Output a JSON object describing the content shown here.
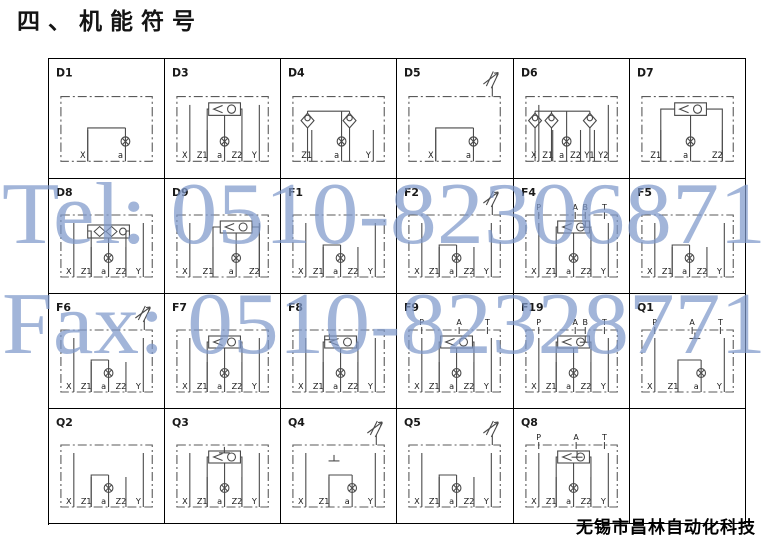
{
  "page": {
    "title": "四、机能符号",
    "footer": "无锡市昌林自动化科技"
  },
  "watermark": {
    "line1": "Tel: 0510-82306871",
    "line2": "Fax: 0510-82328771",
    "color": "#7E99CB"
  },
  "colors": {
    "line": "#4a4a4a",
    "envelope": "#5a5a5a",
    "label": "#1a1a1a",
    "border": "#000000"
  },
  "cells": [
    {
      "id": "D1",
      "ports": [
        "X",
        "a"
      ],
      "top": [],
      "kind": "bridge",
      "checks": [],
      "relief": false,
      "tank": null
    },
    {
      "id": "D3",
      "ports": [
        "X",
        "Z1",
        "a",
        "Z2",
        "Y"
      ],
      "top": [],
      "kind": "shuttle",
      "checks": [],
      "relief": false,
      "tank": null
    },
    {
      "id": "D4",
      "ports": [
        "Z1",
        "a",
        "Y"
      ],
      "top": [],
      "kind": "checks",
      "checks": [
        0.16,
        0.62
      ],
      "relief": false,
      "tank": null
    },
    {
      "id": "D5",
      "ports": [
        "X",
        "a"
      ],
      "top": [],
      "kind": "bridge",
      "checks": [],
      "relief": true,
      "tank": null
    },
    {
      "id": "D6",
      "ports": [
        "X",
        "Z1",
        "a",
        "Z2",
        "Y1",
        "Y2"
      ],
      "top": [],
      "kind": "checks",
      "checks": [
        0.1,
        0.28,
        0.7
      ],
      "relief": false,
      "tank": null
    },
    {
      "id": "D7",
      "ports": [
        "Z1",
        "a",
        "Z2"
      ],
      "top": [],
      "kind": "shuttle",
      "checks": [],
      "relief": false,
      "tank": null
    },
    {
      "id": "D8",
      "ports": [
        "X",
        "Z1",
        "a",
        "Z2",
        "Y"
      ],
      "top": [],
      "kind": "dblcheck",
      "checks": [],
      "relief": false,
      "tank": null
    },
    {
      "id": "D9",
      "ports": [
        "X",
        "Z1",
        "a",
        "Z2"
      ],
      "top": [],
      "kind": "shuttle",
      "checks": [],
      "relief": false,
      "tank": null
    },
    {
      "id": "F1",
      "ports": [
        "X",
        "Z1",
        "a",
        "Z2",
        "Y"
      ],
      "top": [],
      "kind": "bridge",
      "checks": [],
      "relief": false,
      "tank": null
    },
    {
      "id": "F2",
      "ports": [
        "X",
        "Z1",
        "a",
        "Z2",
        "Y"
      ],
      "top": [],
      "kind": "bridge",
      "checks": [],
      "relief": true,
      "tank": null
    },
    {
      "id": "F4",
      "ports": [
        "X",
        "Z1",
        "a",
        "Z2",
        "Y"
      ],
      "top": [
        {
          "t": "P",
          "f": 0.14
        },
        {
          "t": "A",
          "f": 0.54
        },
        {
          "t": "B",
          "f": 0.65
        },
        {
          "t": "T",
          "f": 0.86
        }
      ],
      "kind": "shuttle",
      "checks": [],
      "relief": false,
      "tank": [
        0.65,
        0.1
      ]
    },
    {
      "id": "F5",
      "ports": [
        "X",
        "Z1",
        "a",
        "Z2",
        "Y"
      ],
      "top": [],
      "kind": "bridge",
      "checks": [],
      "relief": false,
      "tank": null
    },
    {
      "id": "F6",
      "ports": [
        "X",
        "Z1",
        "a",
        "Z2",
        "Y"
      ],
      "top": [],
      "kind": "bridge",
      "checks": [],
      "relief": true,
      "tank": null
    },
    {
      "id": "F7",
      "ports": [
        "X",
        "Z1",
        "a",
        "Z2",
        "Y"
      ],
      "top": [],
      "kind": "shuttle",
      "checks": [],
      "relief": false,
      "tank": null
    },
    {
      "id": "F8",
      "ports": [
        "X",
        "Z1",
        "a",
        "Z2",
        "Y"
      ],
      "top": [],
      "kind": "shuttle",
      "checks": [],
      "relief": false,
      "tank": [
        0.4,
        0.06
      ]
    },
    {
      "id": "F9",
      "ports": [
        "X",
        "Z1",
        "a",
        "Z2",
        "Y"
      ],
      "top": [
        {
          "t": "P",
          "f": 0.14
        },
        {
          "t": "A",
          "f": 0.55
        },
        {
          "t": "T",
          "f": 0.86
        }
      ],
      "kind": "shuttle",
      "checks": [],
      "relief": false,
      "tank": null
    },
    {
      "id": "F19",
      "ports": [
        "X",
        "Z1",
        "a",
        "Z2",
        "Y"
      ],
      "top": [
        {
          "t": "P",
          "f": 0.14
        },
        {
          "t": "A",
          "f": 0.54
        },
        {
          "t": "B",
          "f": 0.65
        },
        {
          "t": "T",
          "f": 0.86
        }
      ],
      "kind": "shuttle",
      "checks": [],
      "relief": false,
      "tank": [
        0.65,
        0.1
      ]
    },
    {
      "id": "Q1",
      "ports": [
        "X",
        "Z1",
        "a",
        "Y"
      ],
      "top": [
        {
          "t": "P",
          "f": 0.14
        },
        {
          "t": "A",
          "f": 0.55
        },
        {
          "t": "T",
          "f": 0.86
        }
      ],
      "kind": "bridge",
      "checks": [],
      "relief": false,
      "tank": [
        0.58,
        0.04
      ]
    },
    {
      "id": "Q2",
      "ports": [
        "X",
        "Z1",
        "a",
        "Z2",
        "Y"
      ],
      "top": [],
      "kind": "bridge",
      "checks": [],
      "relief": false,
      "tank": null
    },
    {
      "id": "Q3",
      "ports": [
        "X",
        "Z1",
        "a",
        "Z2",
        "Y"
      ],
      "top": [],
      "kind": "shuttle",
      "checks": [],
      "relief": false,
      "tank": [
        0.52,
        0.03
      ]
    },
    {
      "id": "Q4",
      "ports": [
        "X",
        "Z1",
        "a",
        "Y"
      ],
      "top": [],
      "kind": "bridge",
      "checks": [],
      "relief": true,
      "tank": [
        0.45,
        0.16
      ]
    },
    {
      "id": "Q5",
      "ports": [
        "X",
        "Z1",
        "a",
        "Z2",
        "Y"
      ],
      "top": [],
      "kind": "bridge",
      "checks": [],
      "relief": true,
      "tank": null
    },
    {
      "id": "Q8",
      "ports": [
        "X",
        "Z1",
        "a",
        "Z2",
        "Y"
      ],
      "top": [
        {
          "t": "P",
          "f": 0.14
        },
        {
          "t": "A",
          "f": 0.55
        },
        {
          "t": "T",
          "f": 0.86
        }
      ],
      "kind": "shuttle",
      "checks": [],
      "relief": false,
      "tank": [
        0.56,
        0.1
      ]
    },
    {
      "id": "",
      "ports": [],
      "top": [],
      "kind": "empty",
      "checks": [],
      "relief": false,
      "tank": null
    }
  ]
}
